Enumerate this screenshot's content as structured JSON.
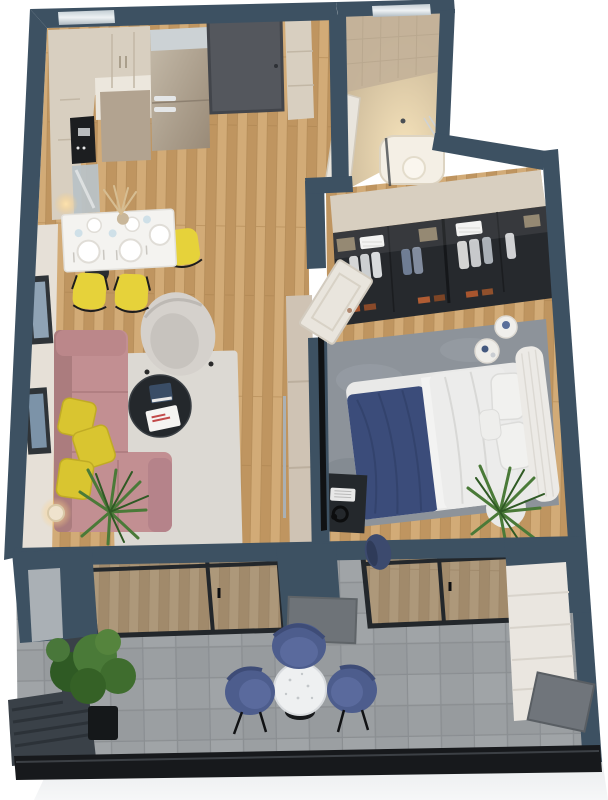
{
  "view": {
    "type": "3d-floorplan-top-down-render",
    "description": "Photorealistic top-down 3D render of a one-bedroom apartment with balcony",
    "background": "white",
    "visible_text": []
  },
  "palette": {
    "background": "#ffffff",
    "wall": "#3d5162",
    "wall_dark": "#2f4050",
    "wall_face_gray": "#aab0b5",
    "wood": "#c9a06b",
    "wood_light": "#d2ab77",
    "wood_dark": "#bf9560",
    "wood_seam": "#a9824e",
    "tile": "#9b9fa2",
    "tile_grout": "#878b8e",
    "facade": "#f2f3f5",
    "rail": "#17191c",
    "cream_cabinet": "#d8cfc0",
    "taupe_cabinet": "#b2a390",
    "counter_white": "#ece7dd",
    "steel_top": "#ccd2d5",
    "steel_body": "#b7a996",
    "door_dark": "#54575d",
    "door_white": "#e9e5dd",
    "table_white": "#f4f3f0",
    "chair_yellow": "#e6d23a",
    "pillow_yellow": "#d9c530",
    "sofa_pink": "#c28f92",
    "sofa_pink_dark": "#ab7c7e",
    "armchair_gray": "#d5d1cc",
    "rug_living": "#dcd9d3",
    "rug_bedroom": "#8d939a",
    "coffee_table_black": "#24282c",
    "bed_white": "#e9e9e8",
    "bed_navy": "#3b4c7a",
    "headboard": "#eceae6",
    "wardrobe_glass": "#26292d",
    "wardrobe_wood": "#8d7f68",
    "bath_wall": "#c3b199",
    "bath_floor": "#dfcfb2",
    "bath_glow": "#f6e3bb",
    "balcony_chair_blue": "#4d5d8d",
    "balcony_chair_blue_light": "#5a6a9d",
    "plant_green": "#4a7a38",
    "plant_green_dark": "#2f5a24",
    "planter_box": "#3a4148",
    "glow_warm": "#eec27e",
    "glass_tint": "#6b7580"
  },
  "rooms": {
    "kitchen": {
      "name": "kitchen",
      "items": [
        "upper-cabinets",
        "counter",
        "cooktop",
        "fridge",
        "entry-door",
        "entry-closet"
      ]
    },
    "dining": {
      "name": "dining-area",
      "items": [
        "dining-table",
        "place-settings",
        "vase-pampas",
        "yellow-chair",
        "yellow-chair",
        "yellow-chair",
        "black-stool"
      ]
    },
    "living": {
      "name": "living-room",
      "items": [
        "pink-sofa",
        "yellow-pillows",
        "gray-armchair",
        "coffee-table",
        "magazine",
        "rug",
        "floor-lamp",
        "palm-plant",
        "wall-frames",
        "tv-console"
      ]
    },
    "bedroom": {
      "name": "bedroom",
      "items": [
        "wardrobe-glass",
        "open-door",
        "double-bed",
        "navy-blanket",
        "pillows",
        "headboard",
        "bedside-tables",
        "rug",
        "desk",
        "keyboard",
        "headphones",
        "office-chair",
        "palm-plant"
      ]
    },
    "bathroom": {
      "name": "bathroom",
      "items": [
        "open-door",
        "bathtub",
        "glass-screen",
        "towel-rail",
        "window"
      ]
    },
    "balcony": {
      "name": "balcony",
      "items": [
        "tile-floor",
        "glass-sliding-doors",
        "round-table",
        "blue-chair",
        "blue-chair",
        "blue-chair",
        "planter-boxes",
        "bushes",
        "white-cabinet",
        "leaning-panels",
        "railing"
      ]
    }
  }
}
